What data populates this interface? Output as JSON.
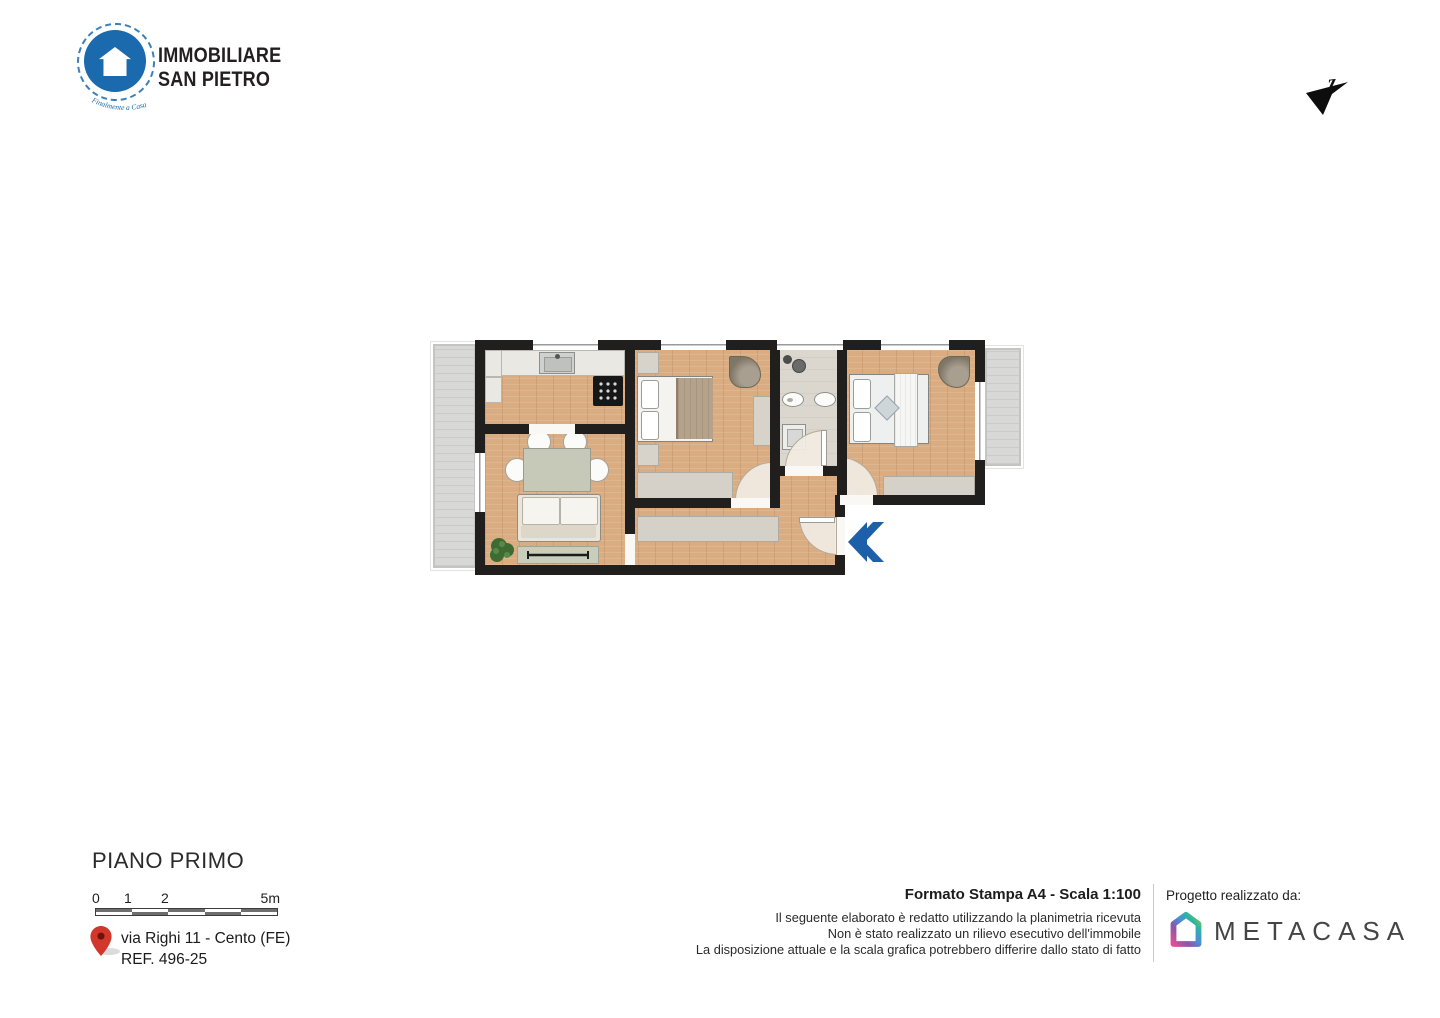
{
  "header": {
    "logo_line1": "IMMOBILIARE",
    "logo_line2": "SAN PIETRO",
    "logo_tagline": "Finalmente a Casa",
    "compass_label": "z"
  },
  "footer_left": {
    "floor_title": "PIANO PRIMO",
    "scale_ticks": [
      "0",
      "1",
      "2",
      "5m"
    ],
    "address_line1": "via Righi 11 - Cento (FE)",
    "address_line2": "REF. 496-25"
  },
  "footer_right": {
    "print_format": "Formato Stampa A4 - Scala 1:100",
    "disclaimer": [
      "Il seguente elaborato è redatto utilizzando la planimetria ricevuta",
      "Non è stato realizzato un rilievo esecutivo dell'immobile",
      "La disposizione attuale e la scala grafica potrebbero differire dallo stato di fatto"
    ],
    "credits_label": "Progetto realizzato da:",
    "credits_brand": "METACASA"
  },
  "plan": {
    "colors": {
      "brand_blue": "#1a6aad",
      "entrance_arrow_blue": "#1d5fa8",
      "pin_red": "#d2372b",
      "wall": "#211f1e",
      "wood_floor": "#d9ac81",
      "bath_floor": "#dcd7ce",
      "balcony_floor": "#d8d8d6",
      "metacasa_gradient": [
        "#8dc63f",
        "#2bb6a3",
        "#4a90d9",
        "#8a57a8",
        "#e04e96"
      ]
    }
  }
}
